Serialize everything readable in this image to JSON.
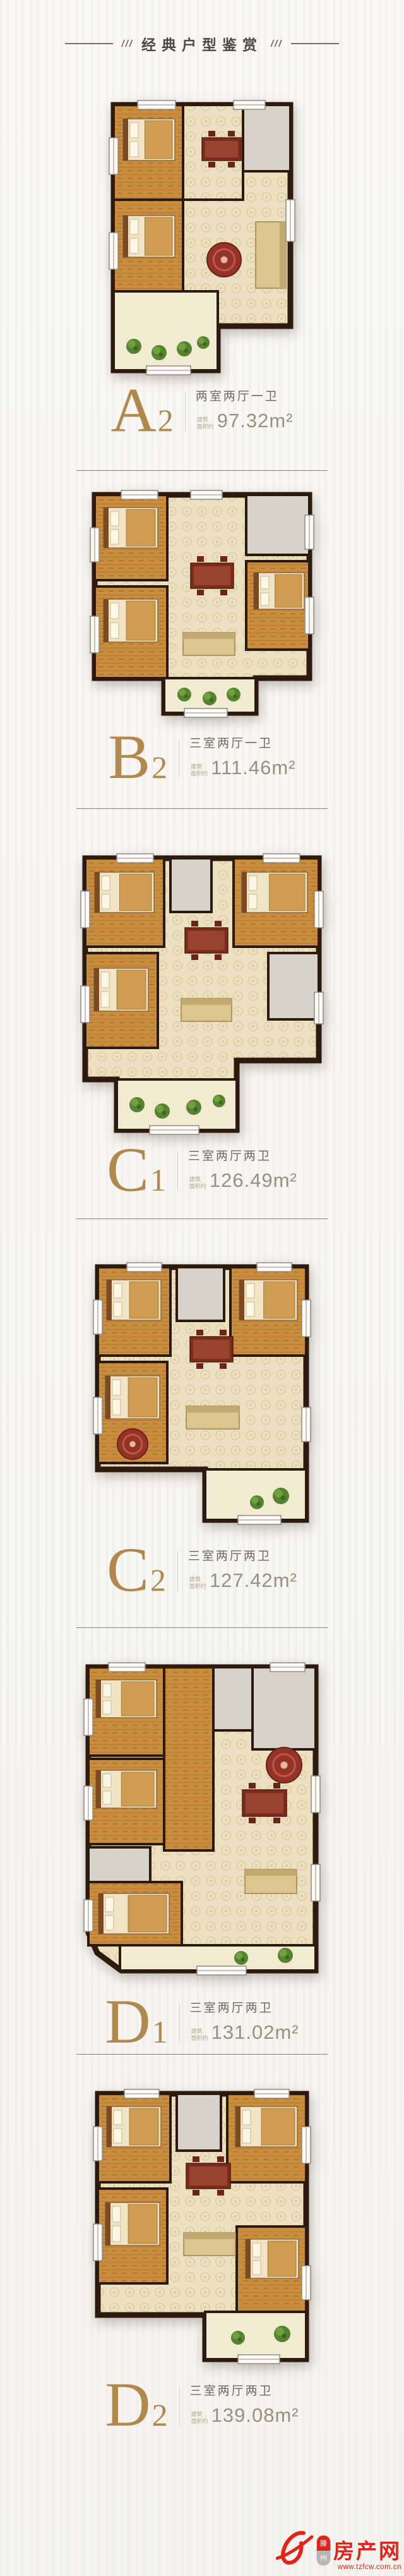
{
  "header": {
    "title": "经典户型鉴赏",
    "decor_left": "///",
    "decor_right": "///"
  },
  "plans": [
    {
      "id": "A2",
      "letter": "A",
      "number": "2",
      "rooms": "两室两厅一卫",
      "area_prefix_line1": "建筑",
      "area_prefix_line2": "面积约",
      "area": "97.32",
      "area_unit": "m²"
    },
    {
      "id": "B2",
      "letter": "B",
      "number": "2",
      "rooms": "三室两厅一卫",
      "area_prefix_line1": "建筑",
      "area_prefix_line2": "面积约",
      "area": "111.46",
      "area_unit": "m²"
    },
    {
      "id": "C1",
      "letter": "C",
      "number": "1",
      "rooms": "三室两厅两卫",
      "area_prefix_line1": "建筑",
      "area_prefix_line2": "面积约",
      "area": "126.49",
      "area_unit": "m²"
    },
    {
      "id": "C2",
      "letter": "C",
      "number": "2",
      "rooms": "三室两厅两卫",
      "area_prefix_line1": "建筑",
      "area_prefix_line2": "面积约",
      "area": "127.42",
      "area_unit": "m²"
    },
    {
      "id": "D1",
      "letter": "D",
      "number": "1",
      "rooms": "三室两厅两卫",
      "area_prefix_line1": "建筑",
      "area_prefix_line2": "面积约",
      "area": "131.02",
      "area_unit": "m²"
    },
    {
      "id": "D2",
      "letter": "D",
      "number": "2",
      "rooms": "三室两厅两卫",
      "area_prefix_line1": "建筑",
      "area_prefix_line2": "面积约",
      "area": "139.08",
      "area_unit": "m²"
    }
  ],
  "watermark": {
    "badge_city_char1": "滕",
    "badge_city_char2": "州",
    "brand": "房产网",
    "url": "www.tzfcw.com.cn",
    "brand_color": "#e2231a"
  },
  "colors": {
    "gold": "#b1894c",
    "text_dark": "#6f6962",
    "area_text": "#9a9080",
    "divider": "#85817b",
    "wall": "#2c1a0e"
  }
}
